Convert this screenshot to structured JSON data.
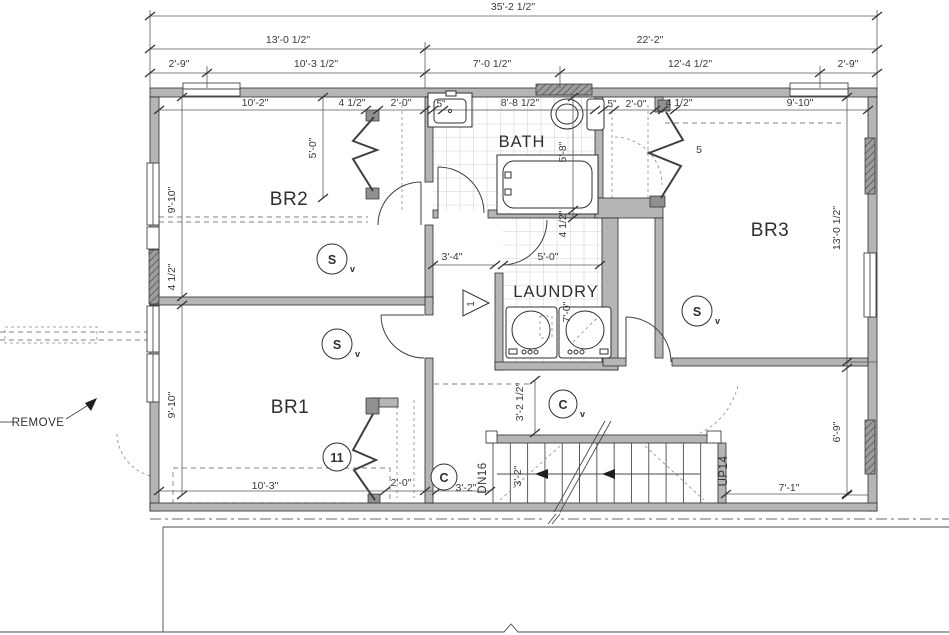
{
  "drawing": {
    "rooms": {
      "br1": "BR1",
      "br2": "BR2",
      "br3": "BR3",
      "bath": "BATH",
      "laundry": "LAUNDRY"
    },
    "labels": {
      "remove": "REMOVE",
      "down": "DN16",
      "up": "UP14"
    },
    "symbols": {
      "smoke": "S",
      "co": "C",
      "sub_v": "v",
      "tag_11": "11",
      "tag_5": "5",
      "tag_1": "1"
    },
    "dims": {
      "overall": "35'-2 1/2\"",
      "left_span": "13'-0 1/2\"",
      "right_span": "22'-2\"",
      "d2_9": "2'-9\"",
      "d10_3h": "10'-3 1/2\"",
      "d7_0h": "7'-0 1/2\"",
      "d12_4h": "12'-4 1/2\"",
      "d10_2": "10'-2\"",
      "d4h": "4 1/2\"",
      "d2_0": "2'-0\"",
      "d5in": "5\"",
      "d8_8h": "8'-8 1/2\"",
      "d9_10": "9'-10\"",
      "d5_0": "5'-0\"",
      "d5_8": "5'-8\"",
      "d13_0h": "13'-0 1/2\"",
      "d3_4": "3'-4\"",
      "d7_0": "7'-0\"",
      "d3_2h": "3'-2 1/2\"",
      "d3_2": "3'-2\"",
      "d10_3": "10'-3\"",
      "d7_1": "7'-1\"",
      "d6_9": "6'-9\""
    }
  }
}
